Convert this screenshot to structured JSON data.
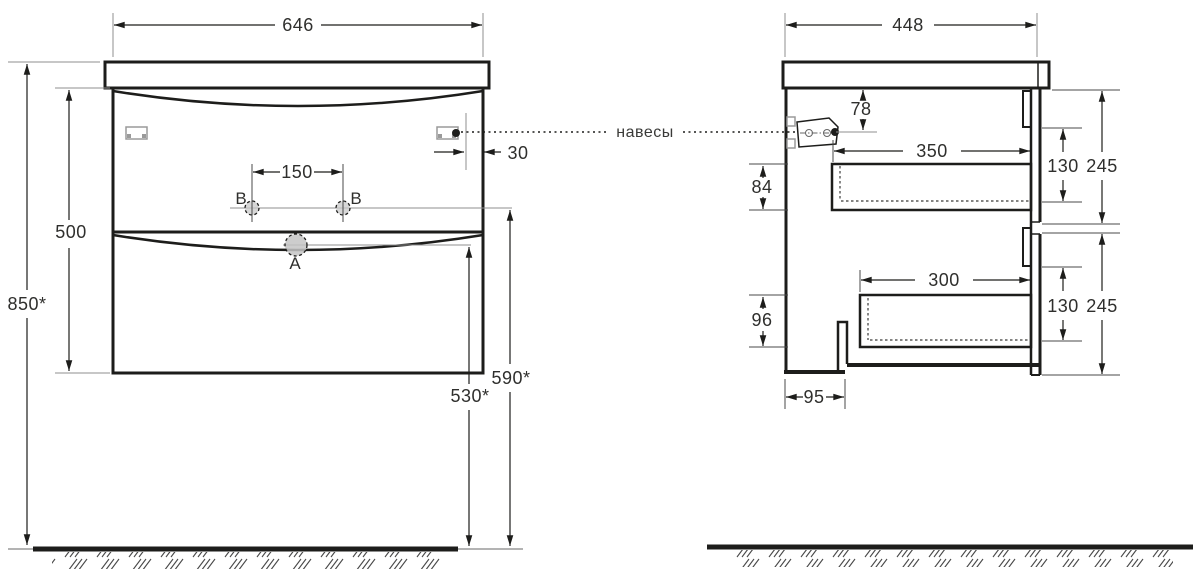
{
  "connector_label": "навесы",
  "front_view": {
    "width_top": "646",
    "cabinet_height": "500",
    "overall_height": "850*",
    "holes_spacing": "150",
    "hanger_inset": "30",
    "hole_a_label": "A",
    "hole_b_left_label": "B",
    "hole_b_right_label": "B",
    "height_to_drain": "530*",
    "height_to_holes": "590*"
  },
  "side_view": {
    "depth_top": "448",
    "hanger_below_top": "78",
    "drawer1_inner_depth": "350",
    "drawer1_box_height": "84",
    "drawer1_inner_height": "130",
    "drawer1_front_height": "245",
    "drawer2_inner_depth": "300",
    "drawer2_box_height": "96",
    "drawer2_inner_height": "130",
    "drawer2_front_height": "245",
    "back_recess_depth": "95"
  },
  "colors": {
    "line": "#1d1d1b",
    "thin_line": "#8f8f8f",
    "text": "#2f2f2d",
    "hole_fill": "#c9c9c9"
  }
}
